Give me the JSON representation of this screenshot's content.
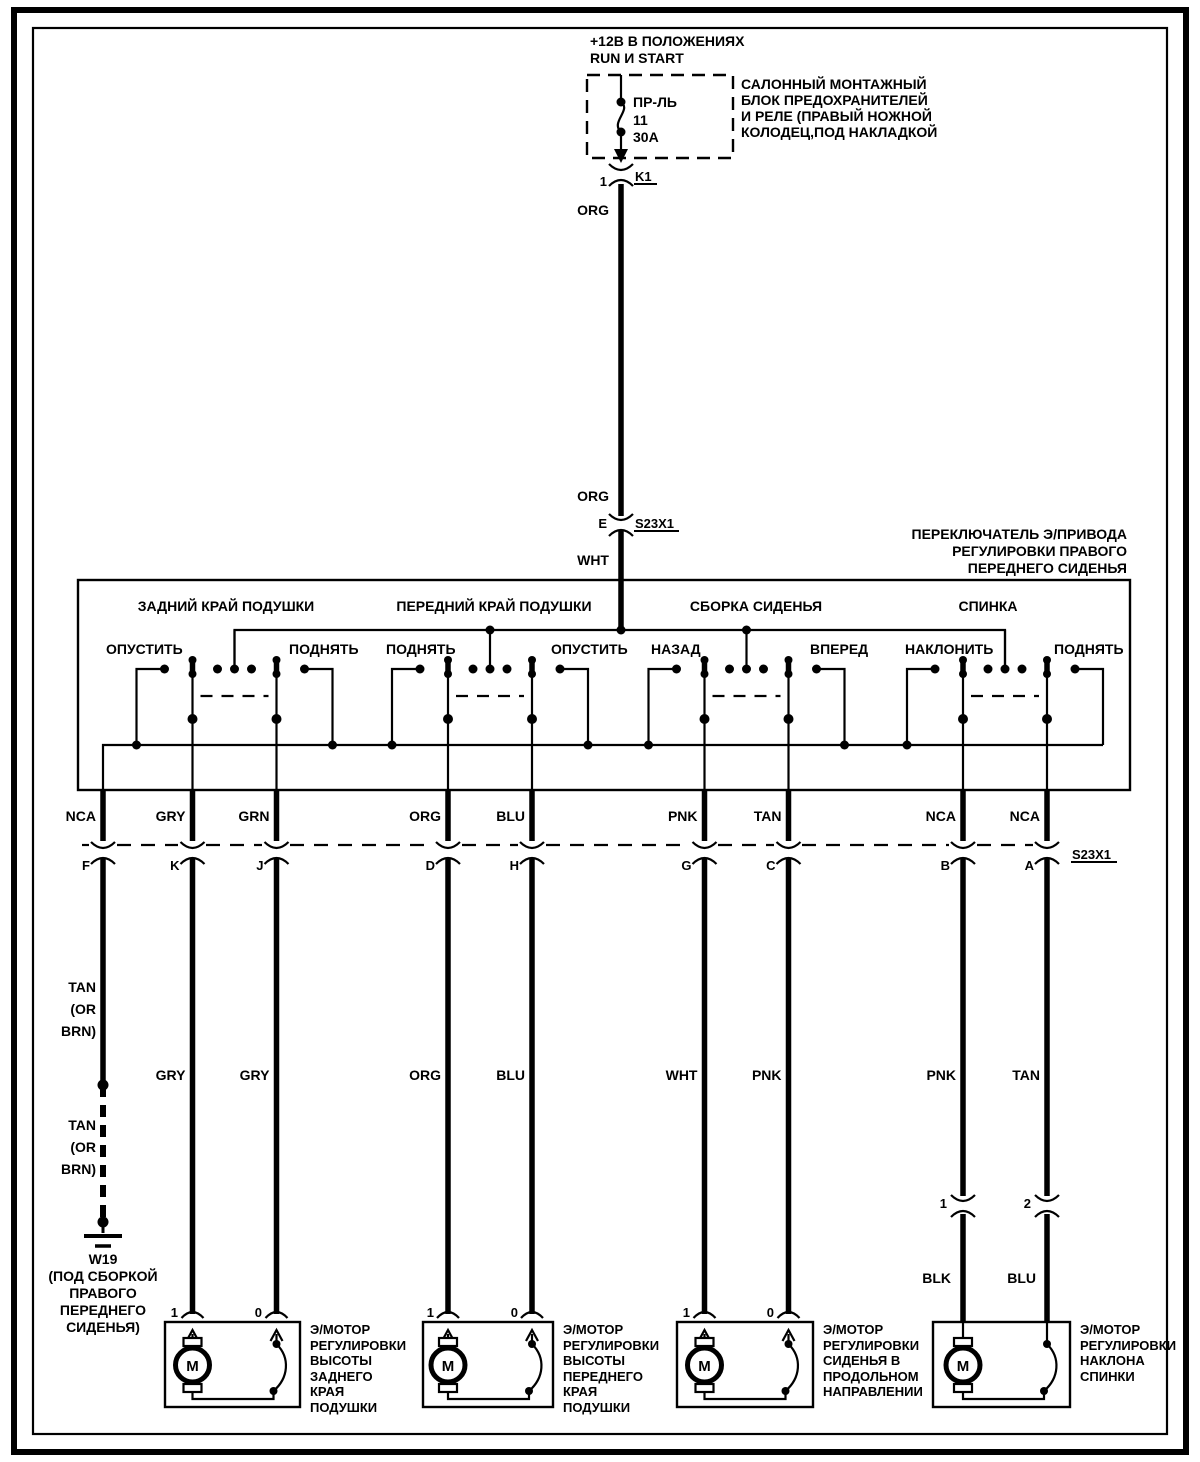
{
  "colors": {
    "ink": "#000000",
    "paper": "#ffffff"
  },
  "power": {
    "lines": [
      "+12В В ПОЛОЖЕНИЯХ",
      "RUN И START"
    ]
  },
  "fuse_box": {
    "fuse_abbr": "ПР-ЛЬ",
    "fuse_number": "11",
    "fuse_rating": "30А",
    "relay_pin": "1",
    "relay_label": "K1",
    "note_lines": [
      "САЛОННЫЙ МОНТАЖНЫЙ",
      "БЛОК ПРЕДОХРАНИТЕЛЕЙ",
      "И РЕЛЕ (ПРАВЫЙ НОЖНОЙ",
      "КОЛОДЕЦ,ПОД НАКЛАДКОЙ"
    ]
  },
  "supply_wire": {
    "color_top": "ORG",
    "color_mid": "ORG",
    "splice_pin": "E",
    "splice_label": "S23X1",
    "color_bottom": "WHT"
  },
  "switch": {
    "title_lines": [
      "ПЕРЕКЛЮЧАТЕЛЬ Э/ПРИВОДА",
      "РЕГУЛИРОВКИ ПРАВОГО",
      "ПЕРЕДНЕГО СИДЕНЬЯ"
    ],
    "sections": [
      {
        "title": "ЗАДНИЙ КРАЙ ПОДУШКИ",
        "left_label": "ОПУСТИТЬ",
        "right_label": "ПОДНЯТЬ"
      },
      {
        "title": "ПЕРЕДНИЙ КРАЙ ПОДУШКИ",
        "left_label": "ПОДНЯТЬ",
        "right_label": "ОПУСТИТЬ"
      },
      {
        "title": "СБОРКА СИДЕНЬЯ",
        "left_label": "НАЗАД",
        "right_label": "ВПЕРЕД"
      },
      {
        "title": "СПИНКА",
        "left_label": "НАКЛОНИТЬ",
        "right_label": "ПОДНЯТЬ"
      }
    ]
  },
  "connector_row": {
    "label": "S23X1",
    "columns": [
      {
        "pin": "F",
        "color_above": "NCA"
      },
      {
        "pin": "K",
        "color_above": "GRY",
        "color_below": "GRY"
      },
      {
        "pin": "J",
        "color_above": "GRN",
        "color_below": "GRY"
      },
      {
        "pin": "D",
        "color_above": "ORG",
        "color_below": "ORG"
      },
      {
        "pin": "H",
        "color_above": "BLU",
        "color_below": "BLU"
      },
      {
        "pin": "G",
        "color_above": "PNK",
        "color_below": "WHT"
      },
      {
        "pin": "C",
        "color_above": "TAN",
        "color_below": "PNK"
      },
      {
        "pin": "B",
        "color_above": "NCA",
        "color_below": "PNK"
      },
      {
        "pin": "A",
        "color_above": "NCA",
        "color_below": "TAN"
      }
    ]
  },
  "ground_branch": {
    "color_lines_upper": [
      "TAN",
      "(OR",
      "BRN)"
    ],
    "color_lines_lower": [
      "TAN",
      "(OR",
      "BRN)"
    ],
    "ground_id": "W19",
    "note_lines": [
      "(ПОД СБОРКОЙ",
      "ПРАВОГО",
      "ПЕРЕДНЕГО",
      "СИДЕНЬЯ)"
    ]
  },
  "seat_connectors": [
    {
      "pin": "1",
      "color_below": "BLK"
    },
    {
      "pin": "2",
      "color_below": "BLU"
    }
  ],
  "motors": [
    {
      "pin_left": "1",
      "pin_right": "0",
      "symbol": "M",
      "label_lines": [
        "Э/МОТОР",
        "РЕГУЛИРОВКИ",
        "ВЫСОТЫ",
        "ЗАДНЕГО",
        "КРАЯ",
        "ПОДУШКИ"
      ]
    },
    {
      "pin_left": "1",
      "pin_right": "0",
      "symbol": "M",
      "label_lines": [
        "Э/МОТОР",
        "РЕГУЛИРОВКИ",
        "ВЫСОТЫ",
        "ПЕРЕДНЕГО",
        "КРАЯ",
        "ПОДУШКИ"
      ]
    },
    {
      "pin_left": "1",
      "pin_right": "0",
      "symbol": "M",
      "label_lines": [
        "Э/МОТОР",
        "РЕГУЛИРОВКИ",
        "СИДЕНЬЯ В",
        "ПРОДОЛЬНОМ",
        "НАПРАВЛЕНИИ"
      ]
    },
    {
      "symbol": "M",
      "label_lines": [
        "Э/МОТОР",
        "РЕГУЛИРОВКИ",
        "НАКЛОНА",
        "СПИНКИ"
      ]
    }
  ]
}
